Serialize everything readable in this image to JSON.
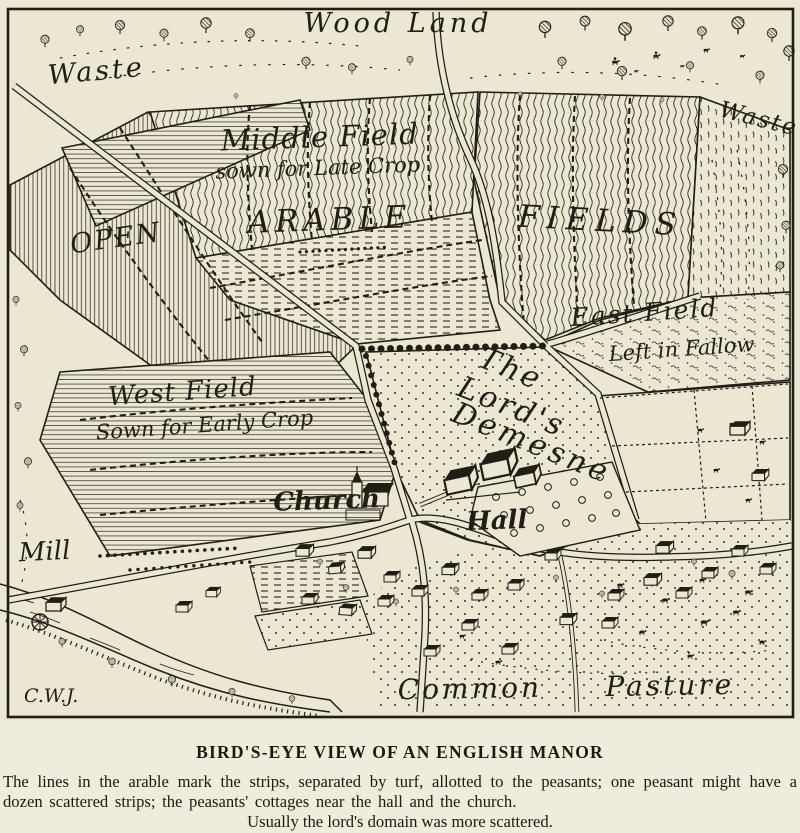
{
  "figure": {
    "colors": {
      "paper": "#ece7d3",
      "caption_bg": "#edecdd",
      "ink": "#221d15"
    },
    "labels": {
      "wood_land": "Wood Land",
      "waste_left": "Waste",
      "waste_right": "Waste",
      "middle_field": "Middle Field",
      "middle_field_note": "sown for Late Crop",
      "open": "OPEN",
      "arable": "ARABLE",
      "fields": "FIELDS",
      "east_field": "East Field",
      "east_field_note": "Left in Fallow",
      "west_field": "West Field",
      "west_field_note": "Sown for Early Crop",
      "demesne_line1": "The",
      "demesne_line2": "Lord's",
      "demesne_line3": "Demesne",
      "church": "Church",
      "hall": "Hall",
      "mill": "Mill",
      "common": "Common",
      "pasture": "Pasture",
      "signature": "C.W.J."
    }
  },
  "caption": {
    "title": "BIRD'S-EYE VIEW OF AN ENGLISH MANOR",
    "body": "The lines in the arable mark the strips, separated by turf, allotted to the peasants; one peasant might have a dozen scattered strips; the peasants' cottages near the hall and the church.",
    "footer": "Usually the lord's domain was more scattered."
  }
}
